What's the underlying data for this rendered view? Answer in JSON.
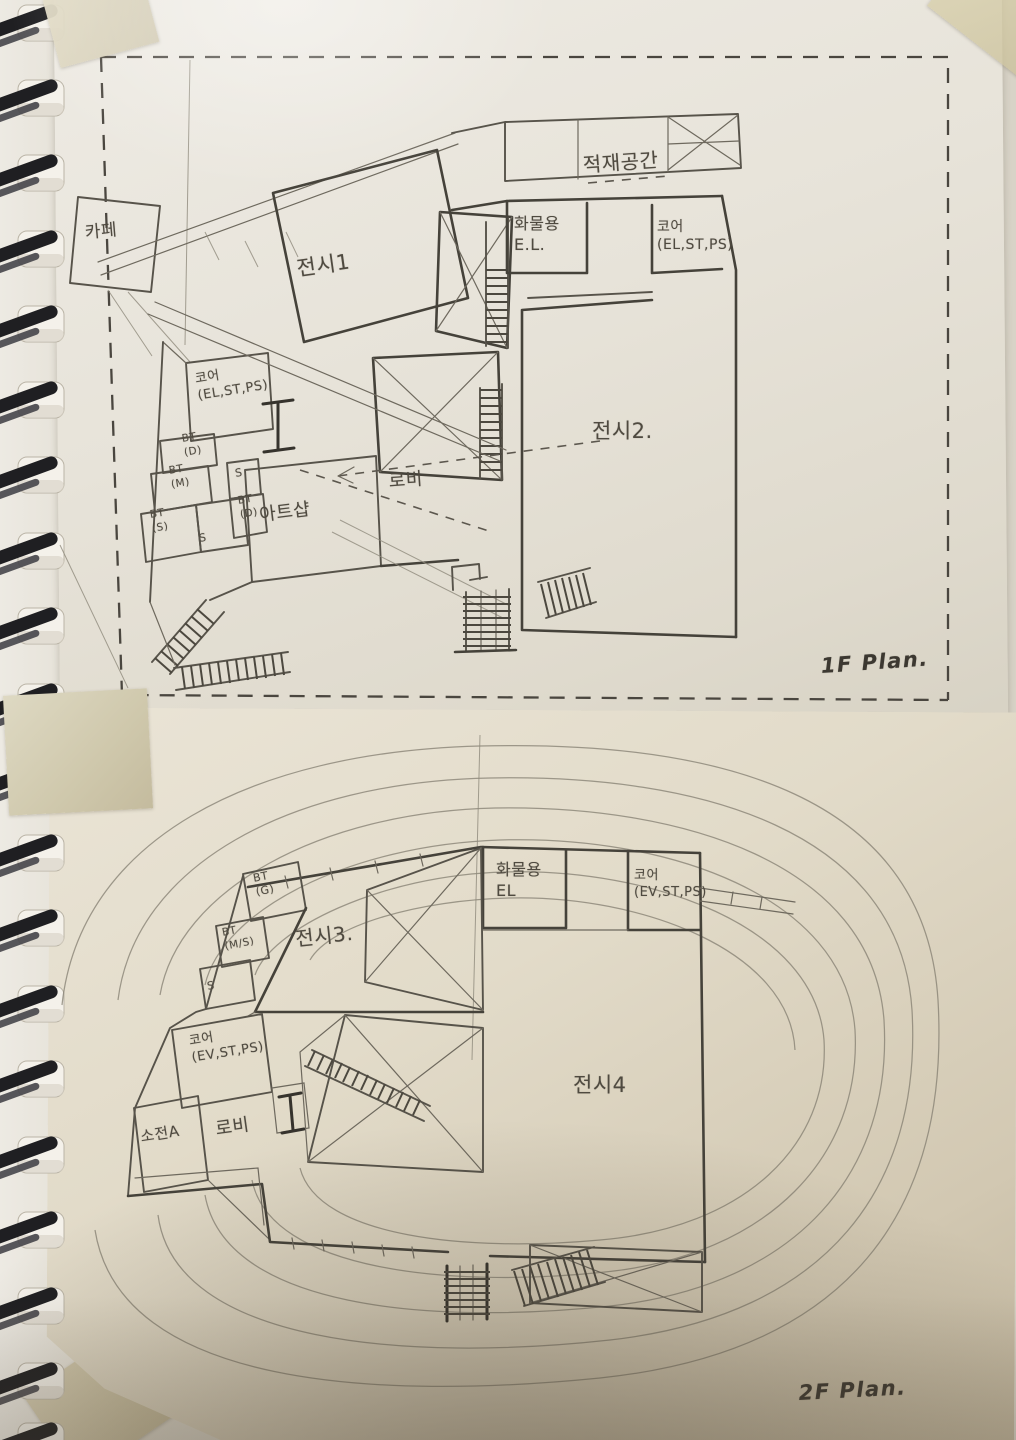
{
  "palette": {
    "pencil": "#4f4a40",
    "pencil_dark": "#36332d",
    "paper_top_sheet": "#e9e6df",
    "paper_bottom_sheet": "#ddd5c4",
    "tape": "#d7d0b8",
    "spiral_coil": "#222225"
  },
  "plan_1f": {
    "title": "1F Plan.",
    "rooms": {
      "cafe": "카페",
      "exhibition1": "전시1",
      "loading_space": "적재공간",
      "freight_elevator": "화물용\nE.L.",
      "core_right": "코어\n(EL,ST,PS)",
      "exhibition2": "전시2.",
      "core_left": "코어\n(EL,ST,PS)",
      "bt_d_upper": "BT\n(D)",
      "bt_m": "BT\n(M)",
      "s_upper": "S",
      "bt_d_lower": "BT\n(D)",
      "bt_s": "BT\n(S)",
      "s_lower": "S",
      "art_shop": "아트샵",
      "lobby": "로비"
    }
  },
  "plan_2f": {
    "title": "2F Plan.",
    "rooms": {
      "bt_g": "BT\n(G)",
      "bt_ms": "BT\n(M/S)",
      "s": "S",
      "exhibition3": "전시3.",
      "freight_elevator": "화물용\nEL",
      "core_right": "코어\n(EV,ST,PS)",
      "core_left": "코어\n(EV,ST,PS)",
      "sojeon_a": "소전A",
      "lobby": "로비",
      "exhibition4": "전시4"
    }
  }
}
